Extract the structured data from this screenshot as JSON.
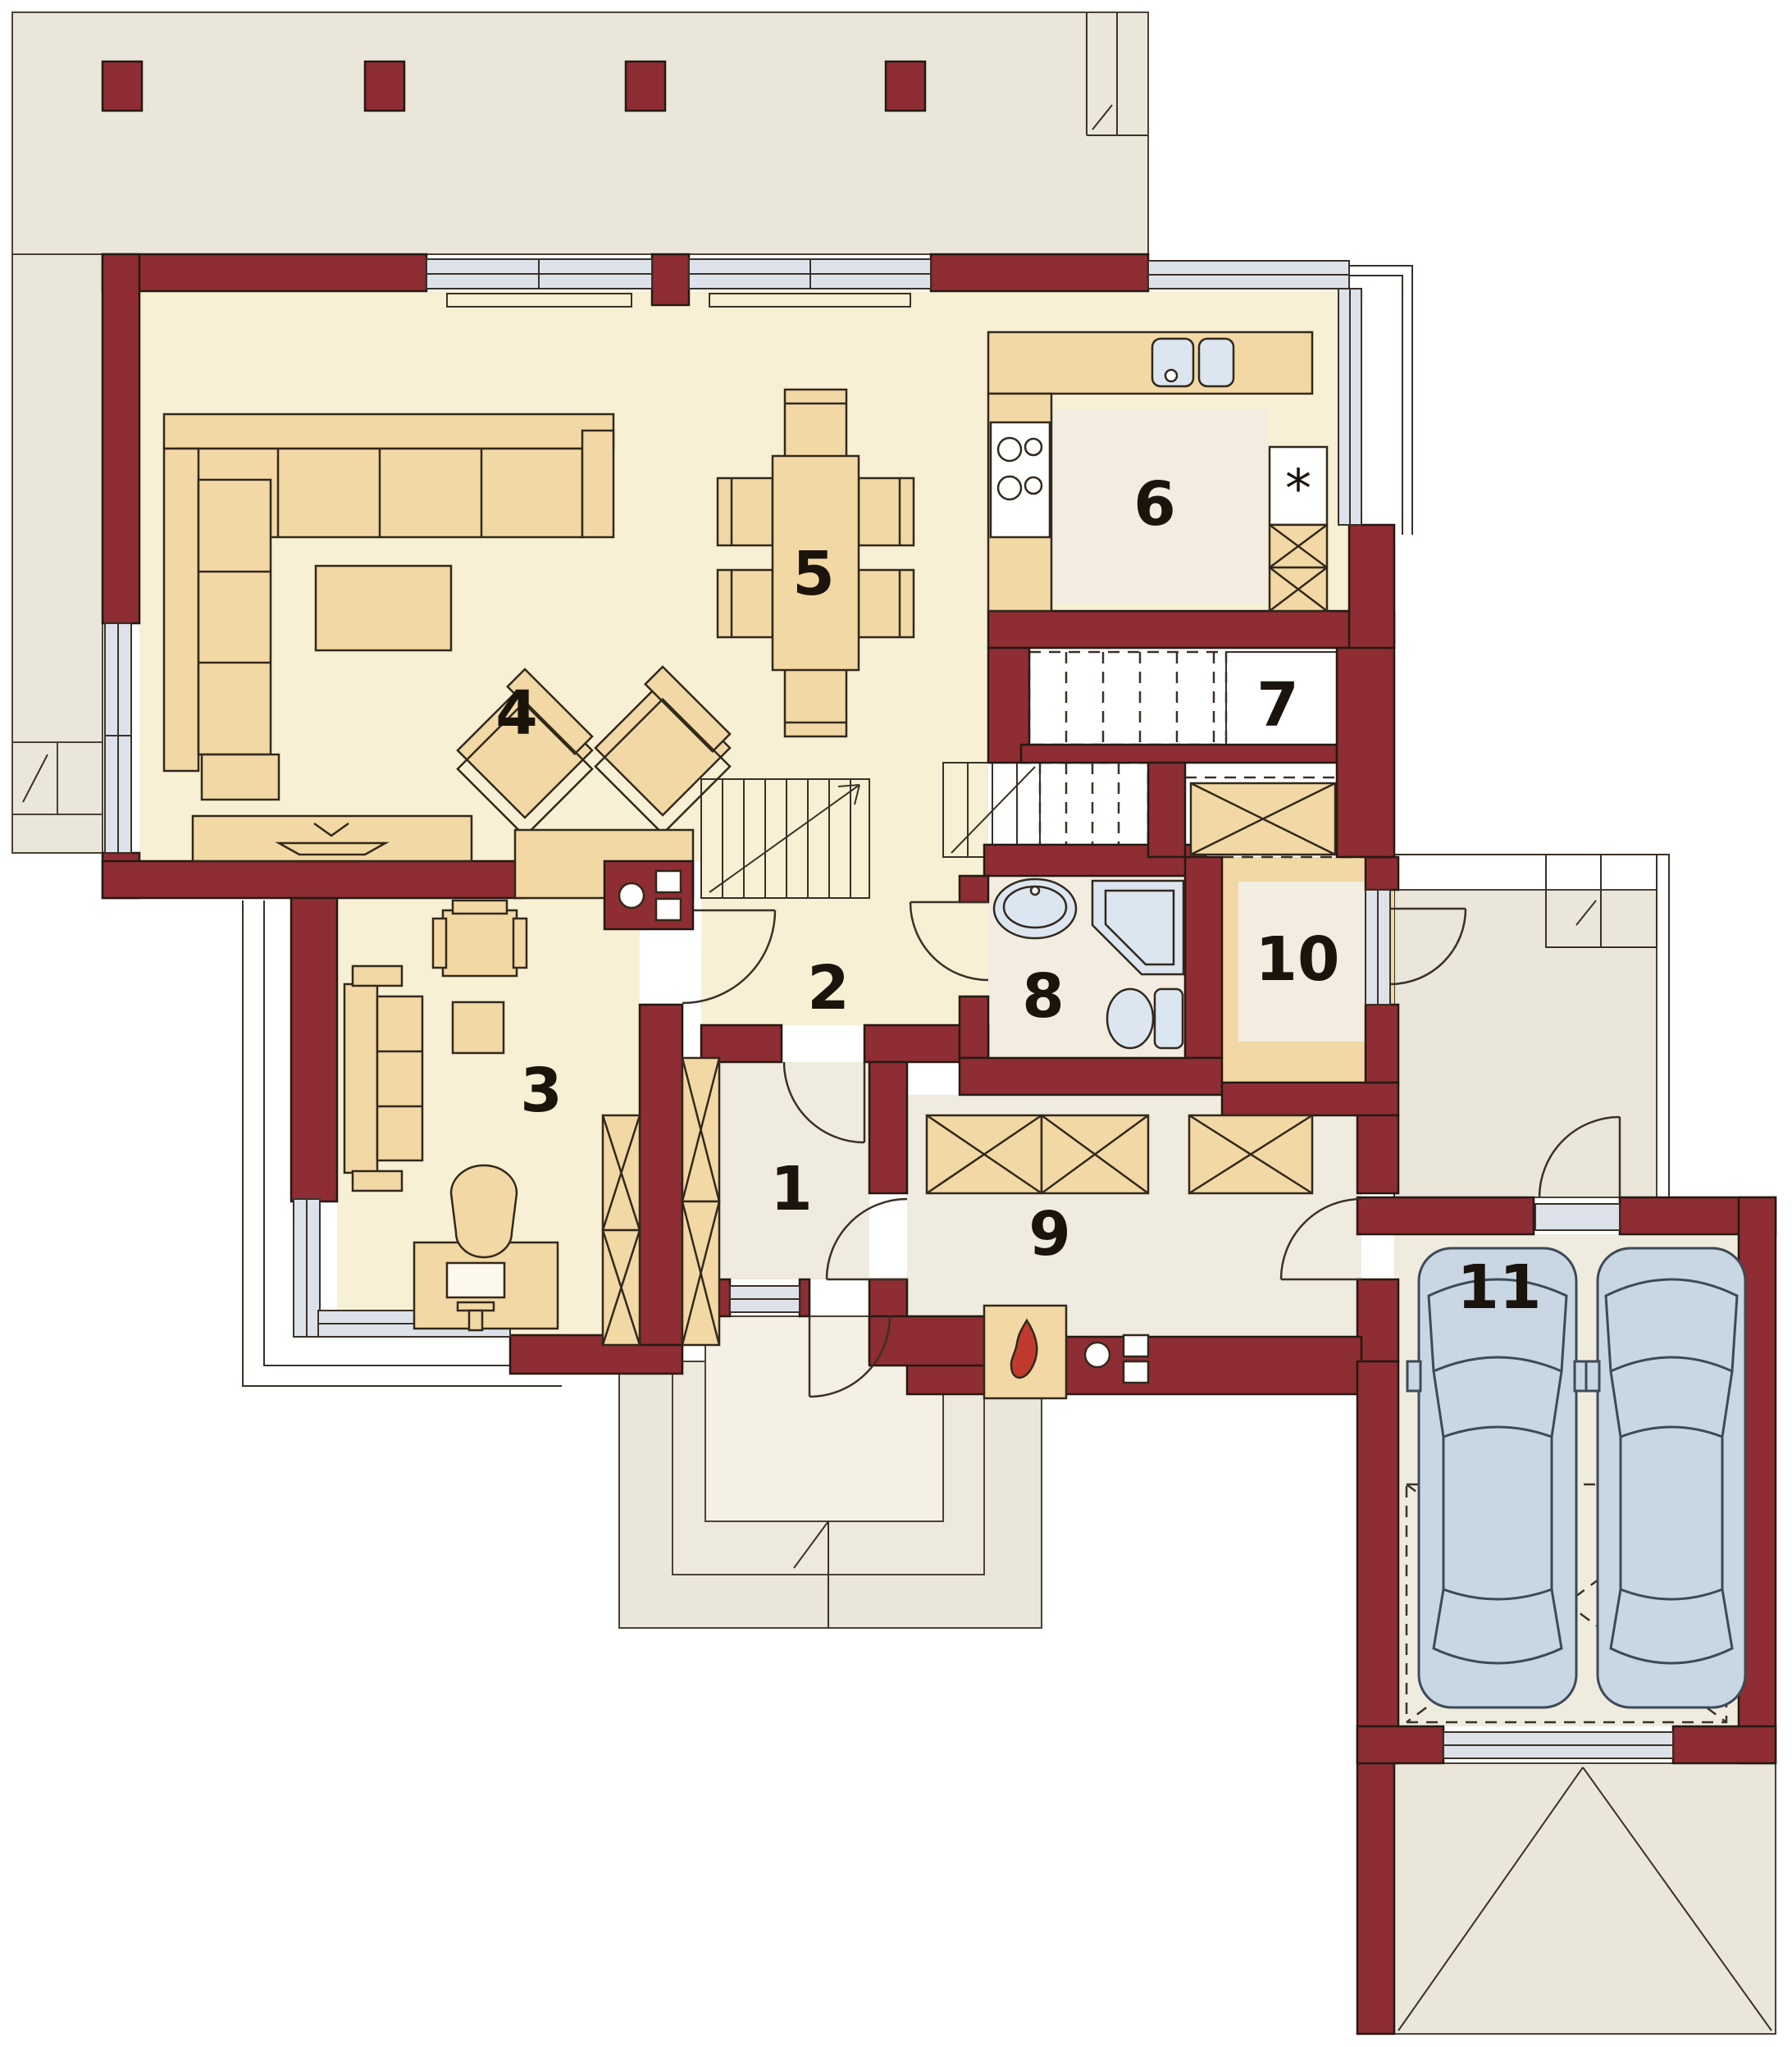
{
  "plan": {
    "rooms": [
      {
        "id": "room-1",
        "label": "1"
      },
      {
        "id": "room-2",
        "label": "2"
      },
      {
        "id": "room-3",
        "label": "3"
      },
      {
        "id": "room-4",
        "label": "4"
      },
      {
        "id": "room-5",
        "label": "5"
      },
      {
        "id": "room-6",
        "label": "6"
      },
      {
        "id": "room-7",
        "label": "7"
      },
      {
        "id": "room-8",
        "label": "8"
      },
      {
        "id": "room-9",
        "label": "9"
      },
      {
        "id": "room-10",
        "label": "10"
      },
      {
        "id": "room-11",
        "label": "11"
      }
    ],
    "icons": {
      "fridge_symbol": "*"
    },
    "colors": {
      "wall": "#8e2d33",
      "exterior": "#eae6da",
      "floor_cream": "#f8f0d4",
      "floor_light": "#f0ebdf",
      "floor_pale": "#f2ece1",
      "stair_light": "#f3efe4",
      "stair_tan": "#f6e9c8",
      "furniture": "#f2d8a4",
      "glazing": "#dde2ea",
      "fixture": "#dbe6f0",
      "car": "#c9d6e3",
      "flame": "#c03a2e"
    }
  }
}
